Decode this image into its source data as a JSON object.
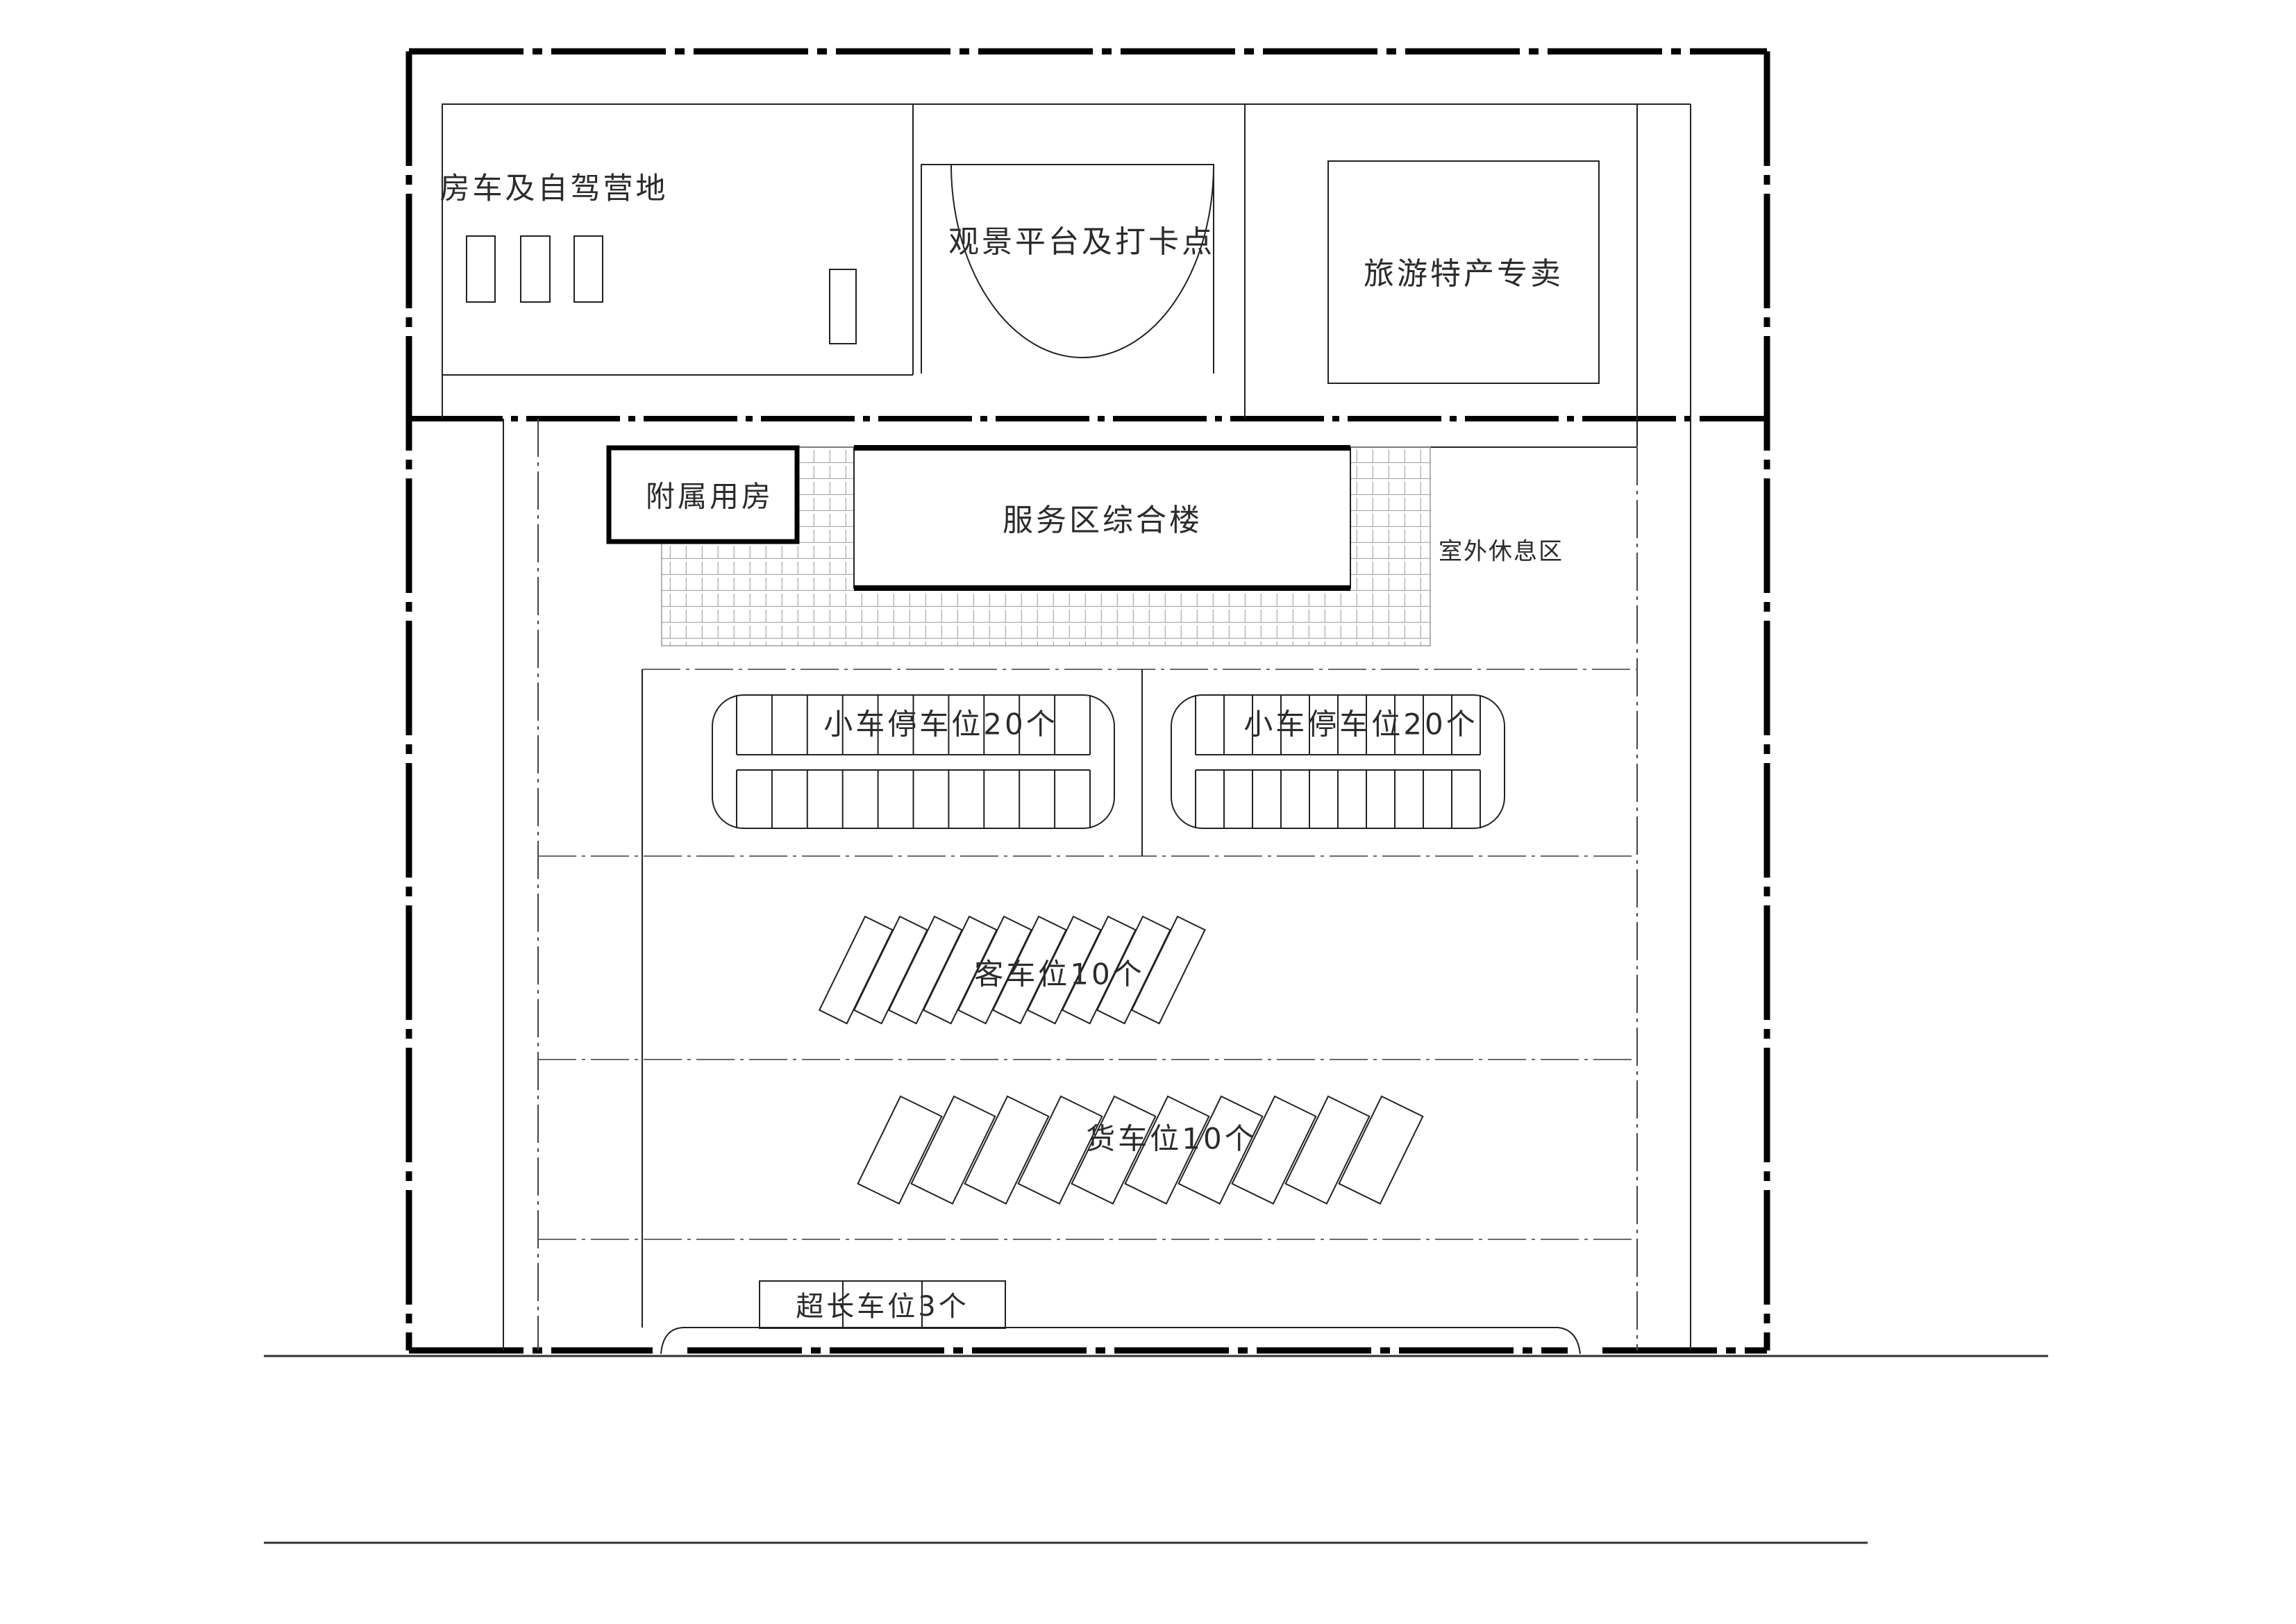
{
  "plan": {
    "top_strip": {
      "camp": {
        "label": "房车及自驾营地",
        "pad_count": 4
      },
      "platform": {
        "label": "观景平台及打卡点"
      },
      "shop": {
        "label": "旅游特产专卖"
      }
    },
    "middle_band": {
      "annex": {
        "label": "附属用房"
      },
      "complex": {
        "label": "服务区综合楼"
      },
      "rest": {
        "label": "室外休息区"
      }
    },
    "parking": {
      "car_lot_left": {
        "label": "小车停车位20个",
        "stalls": 20
      },
      "car_lot_right": {
        "label": "小车停车位20个",
        "stalls": 20
      },
      "bus_row": {
        "label": "客车位10个",
        "stalls": 10
      },
      "truck_row": {
        "label": "货车位10个",
        "stalls": 10
      },
      "long_row": {
        "label": "超长车位3个",
        "stalls": 3
      }
    }
  }
}
